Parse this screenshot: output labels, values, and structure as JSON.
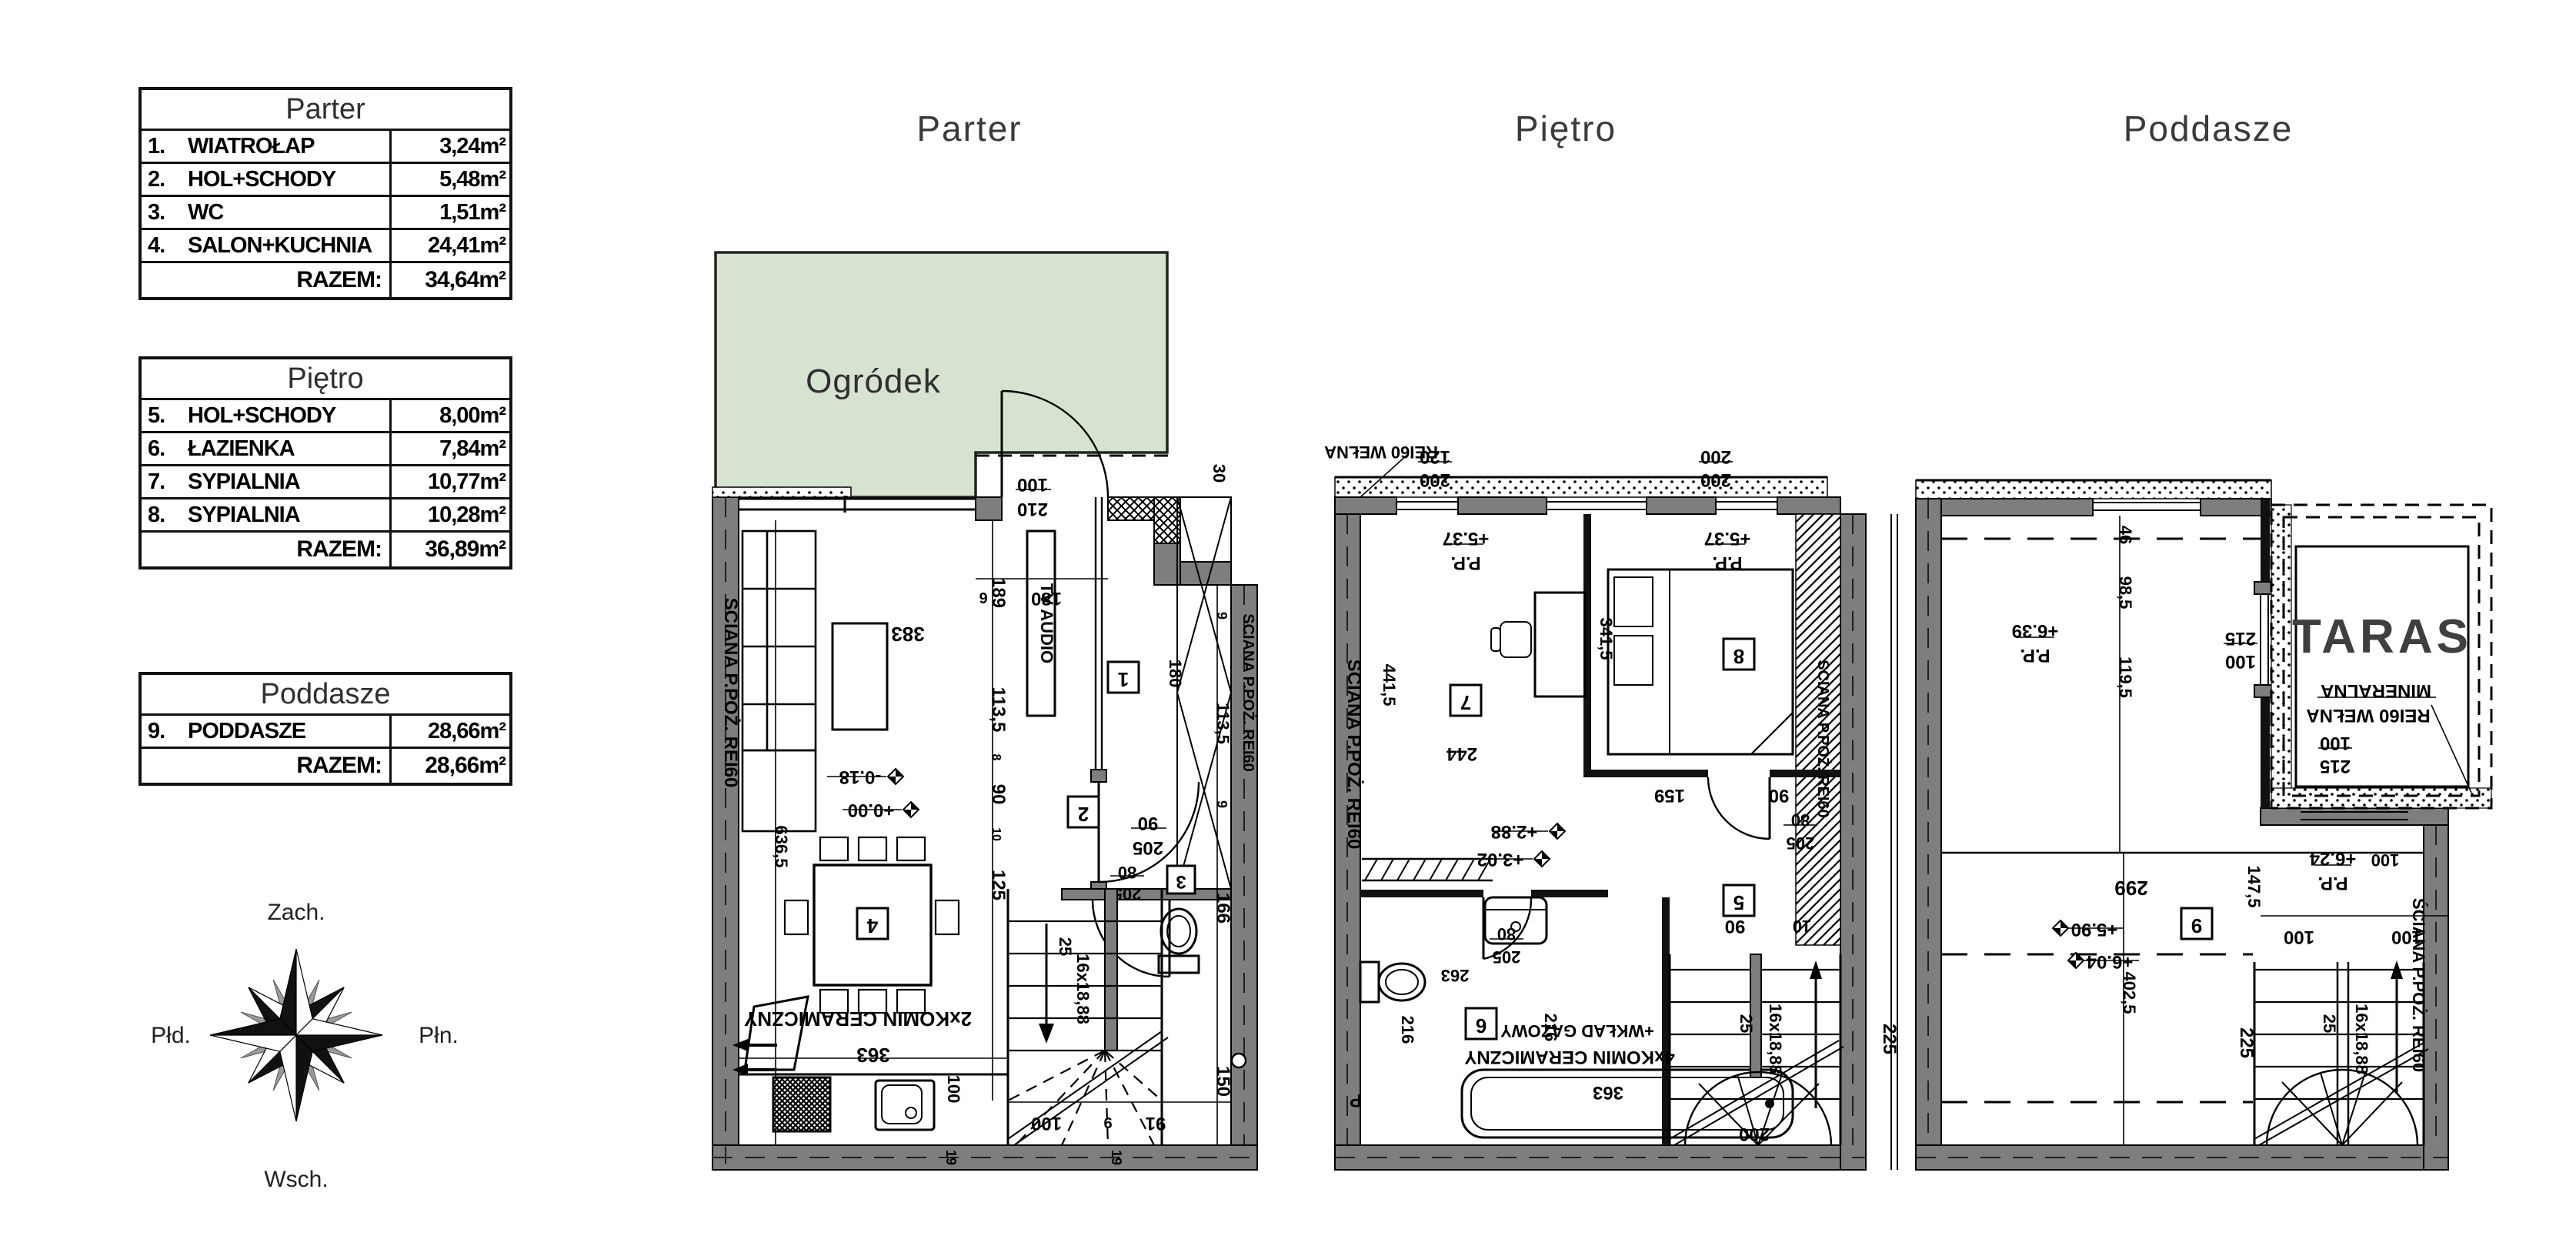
{
  "tables": {
    "razem": "RAZEM:",
    "parter": {
      "title": "Parter",
      "rows": [
        {
          "no": "1.",
          "name": "WIATROŁAP",
          "area": "3,24m²"
        },
        {
          "no": "2.",
          "name": "HOL+SCHODY",
          "area": "5,48m²"
        },
        {
          "no": "3.",
          "name": "WC",
          "area": "1,51m²"
        },
        {
          "no": "4.",
          "name": "SALON+KUCHNIA",
          "area": "24,41m²"
        }
      ],
      "total": "34,64m²"
    },
    "pietro": {
      "title": "Piętro",
      "rows": [
        {
          "no": "5.",
          "name": "HOL+SCHODY",
          "area": "8,00m²"
        },
        {
          "no": "6.",
          "name": "ŁAZIENKA",
          "area": "7,84m²"
        },
        {
          "no": "7.",
          "name": "SYPIALNIA",
          "area": "10,77m²"
        },
        {
          "no": "8.",
          "name": "SYPIALNIA",
          "area": "10,28m²"
        }
      ],
      "total": "36,89m²"
    },
    "poddasze": {
      "title": "Poddasze",
      "rows": [
        {
          "no": "9.",
          "name": "PODDASZE",
          "area": "28,66m²"
        }
      ],
      "total": "28,66m²"
    }
  },
  "plan_titles": {
    "parter": "Parter",
    "pietro": "Piętro",
    "poddasze": "Poddasze"
  },
  "compass": {
    "top": "Zach.",
    "right": "Płn.",
    "bottom": "Wsch.",
    "left": "Płd."
  },
  "labels": {
    "garden": "Ogródek",
    "taras": "TARAS",
    "firewall": "SCIANA P.POŻ. REI60",
    "firewall_s": "ŚCIANA P.POŻ. REI60",
    "rei_welna": "REI60 WEŁNA",
    "mineralna": "MINERALNA",
    "tv": "TV AUDIO",
    "chimney2": "2xKOMIN CERAMICZNY",
    "chimney4": "4xKOMIN CERAMICZNY",
    "wklad": "+WKŁAD GAZOWY",
    "p": "P",
    "pp": "P.P."
  },
  "levels": {
    "l000": "+0.00",
    "l018": "-0.18",
    "l288": "+2.88",
    "l302": "+3.02",
    "l537": "+5.37",
    "l590": "+5.90",
    "l604": "+6.04",
    "l624": "+6.24",
    "l639": "+6.39"
  },
  "tags": {
    "t1": "1",
    "t2": "2",
    "t3": "3",
    "t4": "4",
    "t5": "5",
    "t6": "6",
    "t7": "7",
    "t8": "8",
    "t9": "9"
  },
  "dims": {
    "d6": "6",
    "d9": "9",
    "d8": "8",
    "d10": "10",
    "d19": "19",
    "d25": "25",
    "d30": "30",
    "d46": "46",
    "d80": "80",
    "d90": "90",
    "d91": "91",
    "d98_5": "98,5",
    "d100": "100",
    "d113_5": "113,5",
    "d119_5": "119,5",
    "d120": "120",
    "d125": "125",
    "d147_5": "147,5",
    "d150": "150",
    "d159": "159",
    "d166": "166",
    "d180": "180",
    "d189": "189",
    "d200": "200",
    "d205": "205",
    "d210": "210",
    "d215": "215",
    "d216": "216",
    "d225": "225",
    "d244": "244",
    "d263": "263",
    "d299": "299",
    "d341_5": "341,5",
    "d363": "363",
    "d383": "383",
    "d402_5": "402,5",
    "d441_5": "441,5",
    "d636_5": "636,5",
    "stairs": "16x18,88"
  }
}
